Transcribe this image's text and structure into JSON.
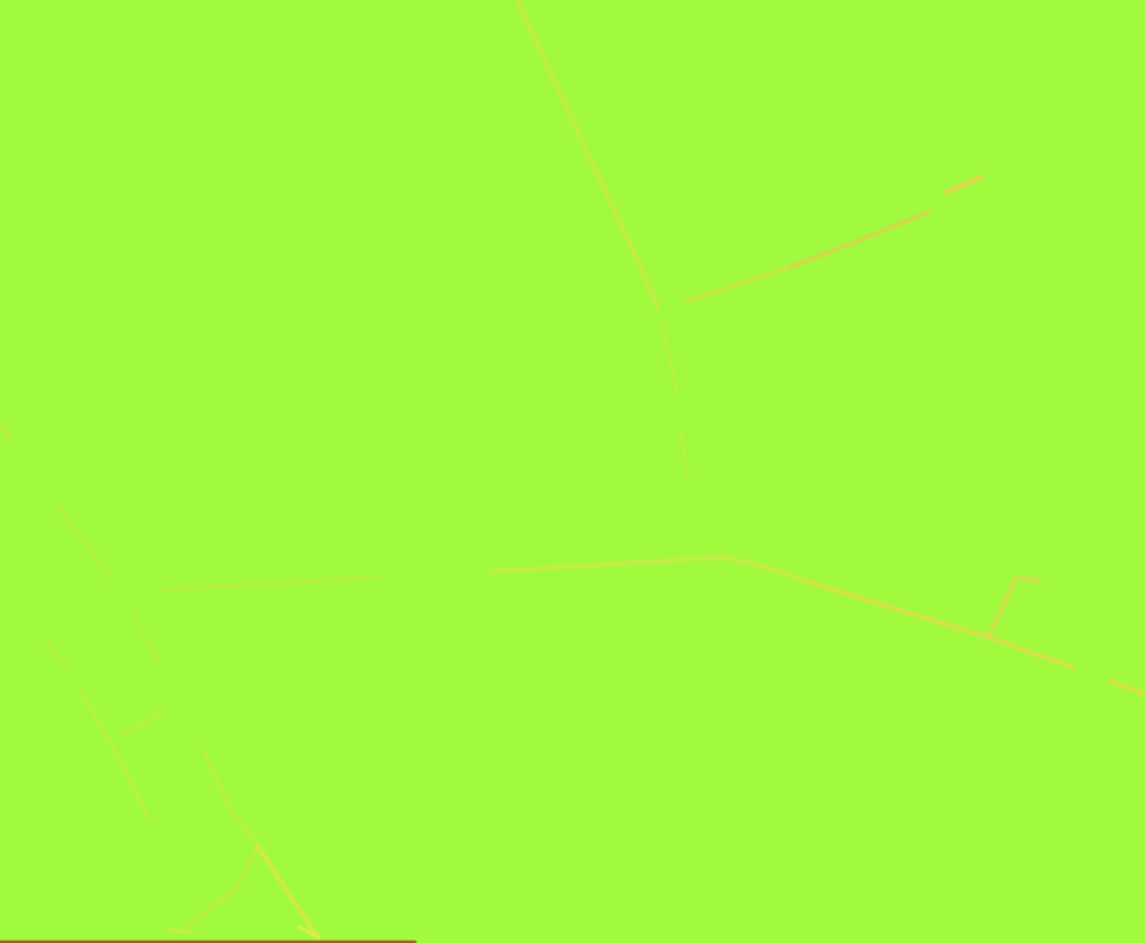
{
  "map": {
    "kind": "terrain-map-view",
    "background_color": "#A1FA3D",
    "width": 1145,
    "height": 943,
    "visible_text": "",
    "labels_visible": false
  },
  "roads": [
    {
      "id": "road-north-diagonal",
      "color": "#C8E94A",
      "width": 5,
      "opacity": 0.8,
      "points": [
        [
          517,
          0
        ],
        [
          600,
          180
        ],
        [
          633,
          250
        ],
        [
          658,
          308
        ]
      ]
    },
    {
      "id": "road-junction-south-stub-1",
      "color": "#C2EC48",
      "width": 4,
      "opacity": 0.6,
      "points": [
        [
          661,
          322
        ],
        [
          677,
          391
        ]
      ]
    },
    {
      "id": "road-junction-south-stub-2",
      "color": "#C2EC48",
      "width": 4,
      "opacity": 0.55,
      "points": [
        [
          681,
          432
        ],
        [
          687,
          477
        ]
      ]
    },
    {
      "id": "road-northeast-branch-a",
      "color": "#D5E04A",
      "width": 4,
      "opacity": 0.75,
      "points": [
        [
          687,
          301
        ],
        [
          790,
          267
        ]
      ]
    },
    {
      "id": "road-northeast-branch-b",
      "color": "#E2CE4C",
      "width": 4,
      "opacity": 0.8,
      "points": [
        [
          790,
          267
        ],
        [
          860,
          240
        ],
        [
          928,
          212
        ]
      ]
    },
    {
      "id": "road-northeast-bright-stub",
      "color": "#E5D44E",
      "width": 5,
      "opacity": 0.9,
      "points": [
        [
          946,
          192
        ],
        [
          981,
          177
        ]
      ]
    },
    {
      "id": "road-main-west",
      "color": "#BEEC47",
      "width": 4,
      "opacity": 0.7,
      "points": [
        [
          163,
          589
        ],
        [
          260,
          584
        ],
        [
          378,
          577
        ]
      ]
    },
    {
      "id": "road-main-middle",
      "color": "#CBE94A",
      "width": 5,
      "opacity": 0.8,
      "points": [
        [
          492,
          571
        ],
        [
          600,
          565
        ],
        [
          723,
          557
        ],
        [
          762,
          566
        ],
        [
          806,
          581
        ]
      ]
    },
    {
      "id": "road-main-east",
      "color": "#D9DF4B",
      "width": 5,
      "opacity": 0.85,
      "points": [
        [
          806,
          581
        ],
        [
          900,
          610
        ],
        [
          988,
          637
        ],
        [
          1073,
          667
        ]
      ]
    },
    {
      "id": "road-main-corner-segment",
      "color": "#D9DF4B",
      "width": 5,
      "opacity": 0.8,
      "points": [
        [
          1110,
          681
        ],
        [
          1145,
          694
        ]
      ]
    },
    {
      "id": "road-east-fork-north",
      "color": "#D5E04B",
      "width": 5,
      "opacity": 0.85,
      "points": [
        [
          988,
          637
        ],
        [
          1016,
          578
        ],
        [
          1038,
          580
        ]
      ]
    },
    {
      "id": "trail-left-edge-mark",
      "color": "#CFE44A",
      "width": 4,
      "opacity": 0.7,
      "points": [
        [
          0,
          424
        ],
        [
          10,
          440
        ]
      ]
    },
    {
      "id": "trail-southwest-1",
      "color": "#BCEE47",
      "width": 4,
      "opacity": 0.65,
      "points": [
        [
          57,
          505
        ],
        [
          110,
          577
        ]
      ]
    },
    {
      "id": "trail-southwest-2",
      "color": "#BCEE47",
      "width": 4,
      "opacity": 0.6,
      "points": [
        [
          131,
          612
        ],
        [
          159,
          663
        ]
      ]
    },
    {
      "id": "trail-southwest-3",
      "color": "#BCEE47",
      "width": 4,
      "opacity": 0.55,
      "points": [
        [
          47,
          641
        ],
        [
          69,
          669
        ]
      ]
    },
    {
      "id": "trail-southwest-main",
      "color": "#C2EC48",
      "width": 4,
      "opacity": 0.7,
      "points": [
        [
          80,
          690
        ],
        [
          120,
          760
        ],
        [
          139,
          798
        ],
        [
          148,
          818
        ]
      ]
    },
    {
      "id": "trail-southwest-branch",
      "color": "#C2EC48",
      "width": 4,
      "opacity": 0.65,
      "points": [
        [
          124,
          734
        ],
        [
          162,
          712
        ]
      ]
    },
    {
      "id": "trail-south-descending",
      "color": "#C2EC48",
      "width": 4,
      "opacity": 0.7,
      "points": [
        [
          204,
          750
        ],
        [
          228,
          805
        ],
        [
          258,
          846
        ]
      ]
    },
    {
      "id": "trail-south-fork-left",
      "color": "#C6EA49",
      "width": 4,
      "opacity": 0.7,
      "points": [
        [
          258,
          846
        ],
        [
          236,
          888
        ],
        [
          179,
          932
        ]
      ]
    },
    {
      "id": "trail-south-fork-right",
      "color": "#D9E54C",
      "width": 5,
      "opacity": 0.8,
      "points": [
        [
          258,
          846
        ],
        [
          290,
          896
        ],
        [
          318,
          937
        ]
      ]
    },
    {
      "id": "trail-bottom-bright-mark",
      "color": "#E2EC4E",
      "width": 4,
      "opacity": 0.8,
      "points": [
        [
          318,
          937
        ],
        [
          299,
          927
        ]
      ]
    },
    {
      "id": "trail-bottom-faint-mark",
      "color": "#D5E84C",
      "width": 3,
      "opacity": 0.7,
      "points": [
        [
          167,
          929
        ],
        [
          193,
          933
        ]
      ]
    },
    {
      "id": "road-bottom-edge-red",
      "color": "#A43B2D",
      "width": 3,
      "opacity": 0.9,
      "points": [
        [
          0,
          942
        ],
        [
          415,
          942
        ]
      ]
    }
  ]
}
